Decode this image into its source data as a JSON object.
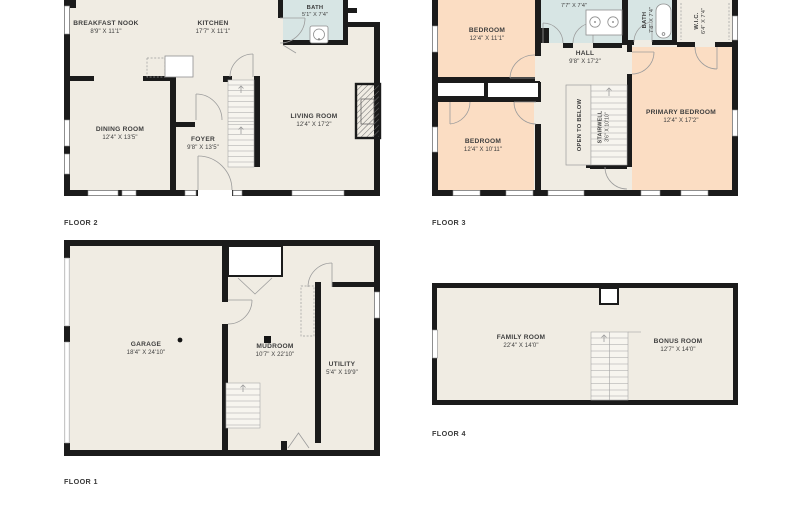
{
  "colors": {
    "background": "#ffffff",
    "room_floor": "#f0ece3",
    "bath_floor": "#d7e5e4",
    "bedroom_floor": "#fbddc3",
    "wall": "#1b1b1b",
    "label_text": "#3e3e3e"
  },
  "floor2": {
    "label": "FLOOR 2",
    "rooms": {
      "breakfast_nook": {
        "name": "BREAKFAST NOOK",
        "dims": "8'9\" X 11'1\""
      },
      "kitchen": {
        "name": "KITCHEN",
        "dims": "17'7\" X 11'1\""
      },
      "bath": {
        "name": "BATH",
        "dims": "5'1\" X 7'4\""
      },
      "dining": {
        "name": "DINING ROOM",
        "dims": "12'4\" X 13'5\""
      },
      "foyer": {
        "name": "FOYER",
        "dims": "9'8\" X 13'5\""
      },
      "living": {
        "name": "LIVING ROOM",
        "dims": "12'4\" X 17'2\""
      }
    }
  },
  "floor3": {
    "label": "FLOOR 3",
    "rooms": {
      "bath_top": {
        "name": "",
        "dims": "7'7\" X 7'4\""
      },
      "bedroom_top": {
        "name": "BEDROOM",
        "dims": "12'4\" X 11'1\""
      },
      "bath": {
        "name": "BATH",
        "dims": "7'8\" X 7'4\""
      },
      "wic": {
        "name": "W.I.C.",
        "dims": "6'4\" X 7'4\""
      },
      "hall": {
        "name": "HALL",
        "dims": "9'8\" X 17'2\""
      },
      "bedroom_lower": {
        "name": "BEDROOM",
        "dims": "12'4\" X 10'11\""
      },
      "open_to_below": {
        "name": "OPEN TO BELOW"
      },
      "stairwell": {
        "name": "STAIRWELL",
        "dims": "3'6\" X 10'10\""
      },
      "primary": {
        "name": "PRIMARY BEDROOM",
        "dims": "12'4\" X 17'2\""
      }
    }
  },
  "floor1": {
    "label": "FLOOR 1",
    "rooms": {
      "garage": {
        "name": "GARAGE",
        "dims": "18'4\" X 24'10\""
      },
      "mudroom": {
        "name": "MUDROOM",
        "dims": "10'7\" X 22'10\""
      },
      "utility": {
        "name": "UTILITY",
        "dims": "5'4\" X 19'9\""
      }
    }
  },
  "floor4": {
    "label": "FLOOR 4",
    "rooms": {
      "family": {
        "name": "FAMILY ROOM",
        "dims": "22'4\" X 14'0\""
      },
      "bonus": {
        "name": "BONUS ROOM",
        "dims": "12'7\" X 14'0\""
      }
    }
  }
}
